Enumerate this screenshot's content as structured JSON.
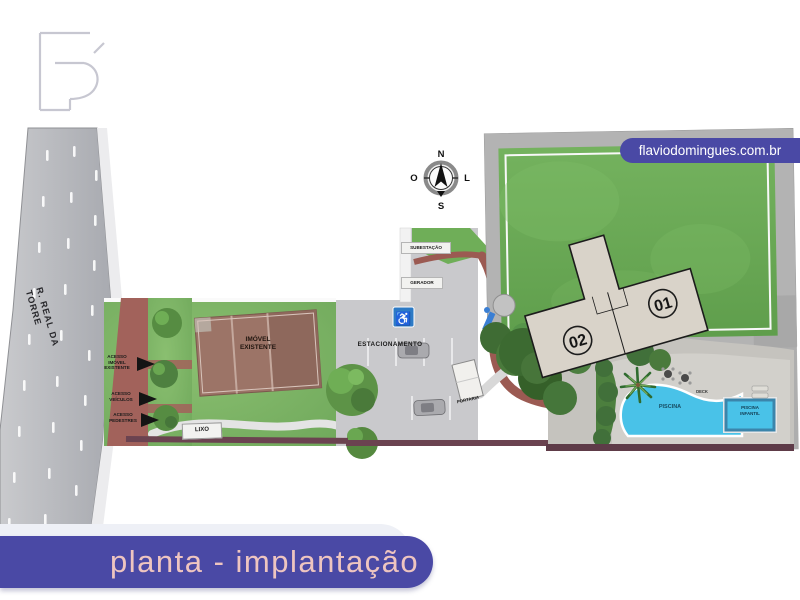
{
  "branding": {
    "website": "flaviodomingues.com.br",
    "logo_monogram": "FD"
  },
  "title_badge": {
    "label": "planta - implantação"
  },
  "compass": {
    "north": "N",
    "south": "S",
    "west": "O",
    "east": "L"
  },
  "street": {
    "name": "R. REAL DA TORRE"
  },
  "access": {
    "existing_property": "ACESSO\nIMÓVEL\nEXISTENTE",
    "vehicles": "ACESSO\nVEÍCULOS",
    "pedestrians": "ACESSO\nPEDESTRES"
  },
  "buildings": {
    "existing_property": "IMÓVEL\nEXISTENTE",
    "tower_left_number": "02",
    "tower_right_number": "01",
    "gatehouse": "PORTARIA"
  },
  "site": {
    "parking": "ESTACIONAMENTO",
    "substation": "SUBESTAÇÃO",
    "generator": "GERADOR",
    "trash": "LIXO",
    "pool": "PISCINA",
    "kids_pool": "PISCINA\nINFANTIL",
    "deck": "DECK",
    "accessible_parking_icon": "♿"
  },
  "colors": {
    "accent_indigo": "#4a49a5",
    "title_text_pink": "#eec5c0",
    "grass_green": "#7cb465",
    "lawn_green": "#69aa55",
    "pool_blue": "#49c2e8",
    "brick_path_red": "#9b5a52",
    "road_gray": "#b4b6bb",
    "tower_beige": "#d9d3c9",
    "roof_brown": "#9c7467",
    "boundary_maroon": "#6b4350"
  }
}
